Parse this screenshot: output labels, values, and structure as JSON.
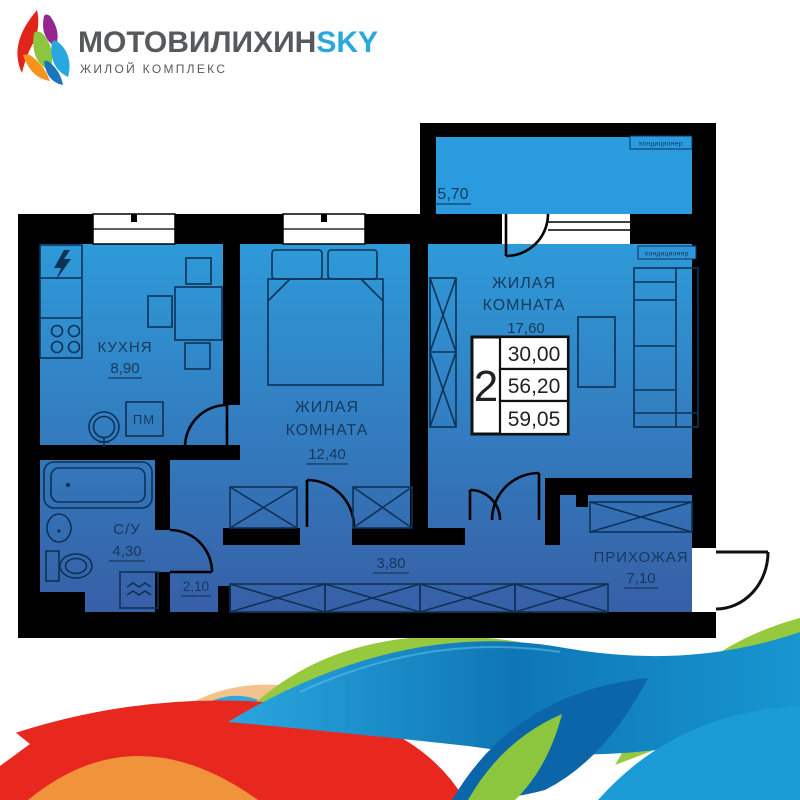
{
  "logo": {
    "title_main": "МОТОВИЛИХИН",
    "title_accent": "SKY",
    "subtitle": "ЖИЛОЙ КОМПЛЕКС"
  },
  "plan": {
    "rooms": {
      "balcony": {
        "area": "5,70"
      },
      "kitchen": {
        "name": "КУХНЯ",
        "area": "8,90"
      },
      "bedroom": {
        "name_line1": "ЖИЛАЯ",
        "name_line2": "КОМНАТА",
        "area": "12,40"
      },
      "living": {
        "name_line1": "ЖИЛАЯ",
        "name_line2": "КОМНАТА",
        "area": "17,60"
      },
      "bathroom": {
        "name": "С/У",
        "area": "4,30"
      },
      "hallway": {
        "name": "ПРИХОЖАЯ",
        "area": "7,10"
      },
      "corridor_small": {
        "area": "2,10"
      },
      "corridor": {
        "area": "3,80"
      }
    },
    "labels": {
      "ac_top": "кондиционер",
      "ac_room": "кондиционер",
      "dishwasher": "ПМ"
    },
    "info_badge": {
      "rooms_count": "2",
      "row1": "30,00",
      "row2": "56,20",
      "row3": "59,05"
    },
    "colors": {
      "wall": "#000000",
      "room_top": "#2E9AD9",
      "room_bottom": "#375FA6",
      "balcony_fill": "#2B9BE0",
      "line": "#0E3256",
      "text": "#16395E"
    }
  },
  "waves": {
    "green": "#96C93D",
    "green_dark": "#8CC63E",
    "blue_light": "#2FA8E0",
    "blue_mid": "#1B9CD6",
    "blue_dark": "#0A66A9",
    "red": "#E8281E",
    "orange": "#F0933A",
    "tan": "#F2C38C"
  }
}
